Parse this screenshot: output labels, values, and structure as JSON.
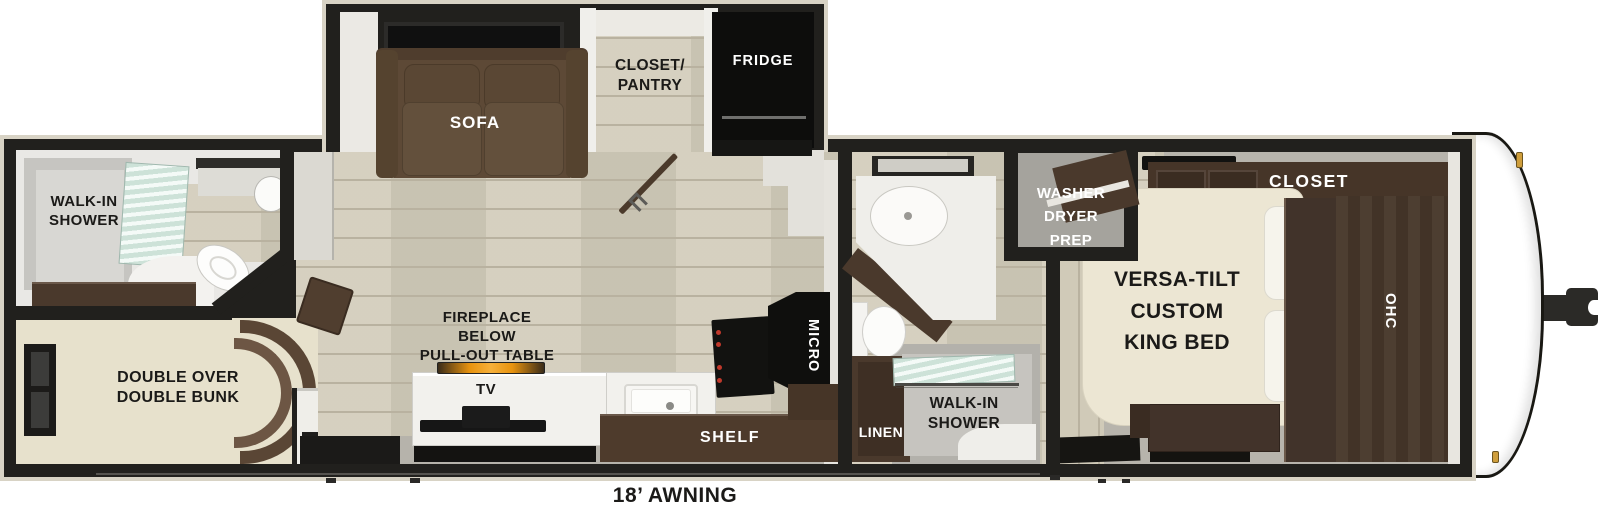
{
  "colors": {
    "wall": "#21201d",
    "outline": "#d8d3c5",
    "wood_floor": "#d3cdbb",
    "gray_floor": "#b7b4ac",
    "carpet": "#e7e1cc",
    "cabinet_brown": "#4a392c",
    "sofa_brown": "#5d4936",
    "counter_white": "#f2f1ed",
    "mattress_cream": "#ece6d3",
    "shower_glass": "#cde2d8",
    "flame_accent": "#e8930f",
    "marker_gold": "#cf9e3c"
  },
  "rooms": {
    "rear_bath": {
      "shower_label": "WALK-IN\nSHOWER"
    },
    "bunk_room": {
      "bunk_label": "DOUBLE OVER\nDOUBLE BUNK"
    },
    "living_kitchen": {
      "sofa_label": "SOFA",
      "closet_pantry_label": "CLOSET/\nPANTRY",
      "fridge_label": "FRIDGE",
      "fireplace_label": "FIREPLACE\nBELOW\nPULL-OUT TABLE",
      "tv_label": "TV",
      "shelf_label": "SHELF",
      "micro_label": "MICRO"
    },
    "mid_bath": {
      "washer_dryer_label": "WASHER\nDRYER\nPREP",
      "linen_label": "LINEN",
      "shower_label": "WALK-IN\nSHOWER"
    },
    "bedroom": {
      "bed_label": "VERSA-TILT\nCUSTOM\nKING BED",
      "closet_label": "CLOSET",
      "ohc_label": "OHC"
    }
  },
  "exterior": {
    "awning_label": "18’ AWNING"
  }
}
